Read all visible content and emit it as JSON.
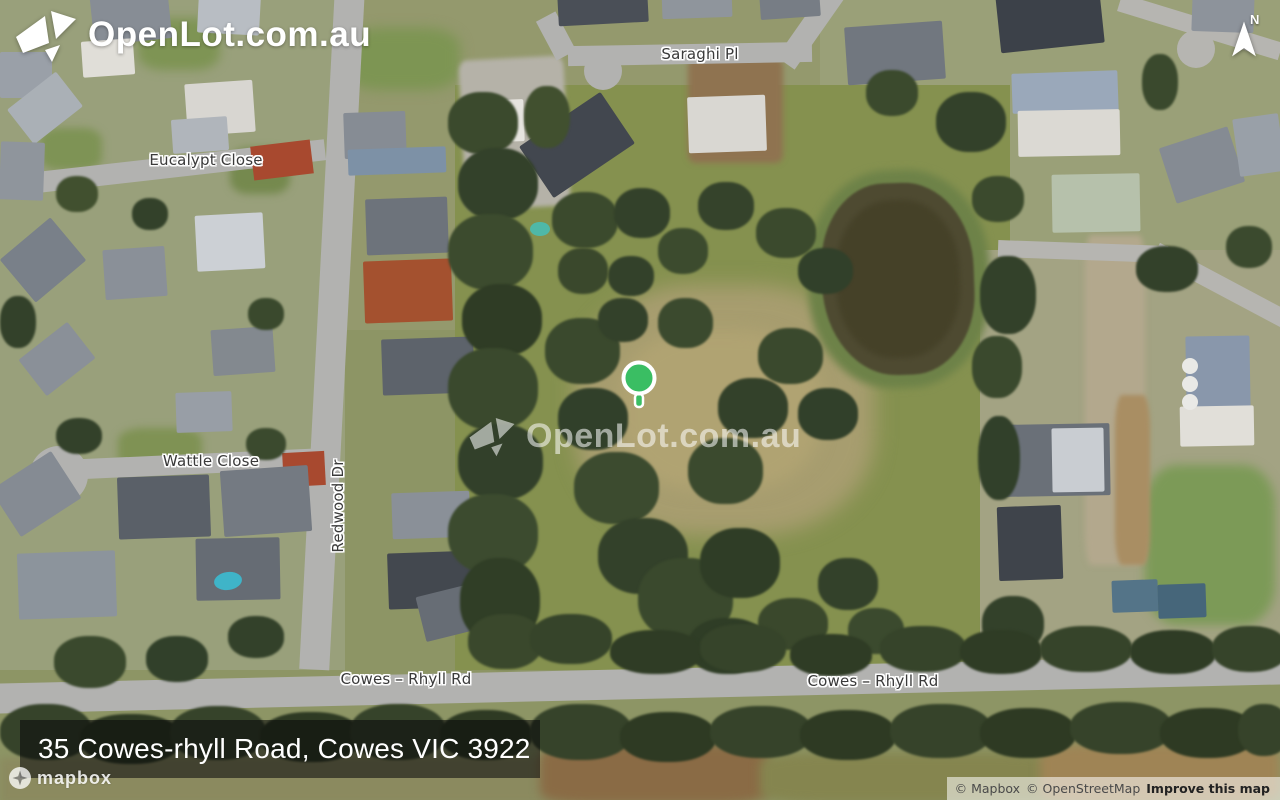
{
  "brand": {
    "name": "OpenLot.com.au"
  },
  "watermark": {
    "text": "OpenLot.com.au"
  },
  "compass": {
    "label": "N"
  },
  "marker": {
    "color": "#3abe63"
  },
  "street_labels": {
    "saraghi": "Saraghi Pl",
    "eucalypt": "Eucalypt Close",
    "wattle": "Wattle Close",
    "redwood": "Redwood Dr",
    "cowes_rhyll_west": "Cowes – Rhyll Rd",
    "cowes_rhyll_east": "Cowes – Rhyll Rd"
  },
  "address_banner": {
    "text": "35 Cowes-rhyll Road, Cowes VIC 3922"
  },
  "attribution": {
    "mapbox_wordmark": "mapbox",
    "mapbox_copyright": "© Mapbox",
    "osm_copyright": "© OpenStreetMap",
    "improve_link": "Improve this map"
  },
  "colors": {
    "banner_bg": "rgba(8,8,10,0.55)",
    "road_gray": "#b2b2b0",
    "pond": "#4e4a31"
  }
}
